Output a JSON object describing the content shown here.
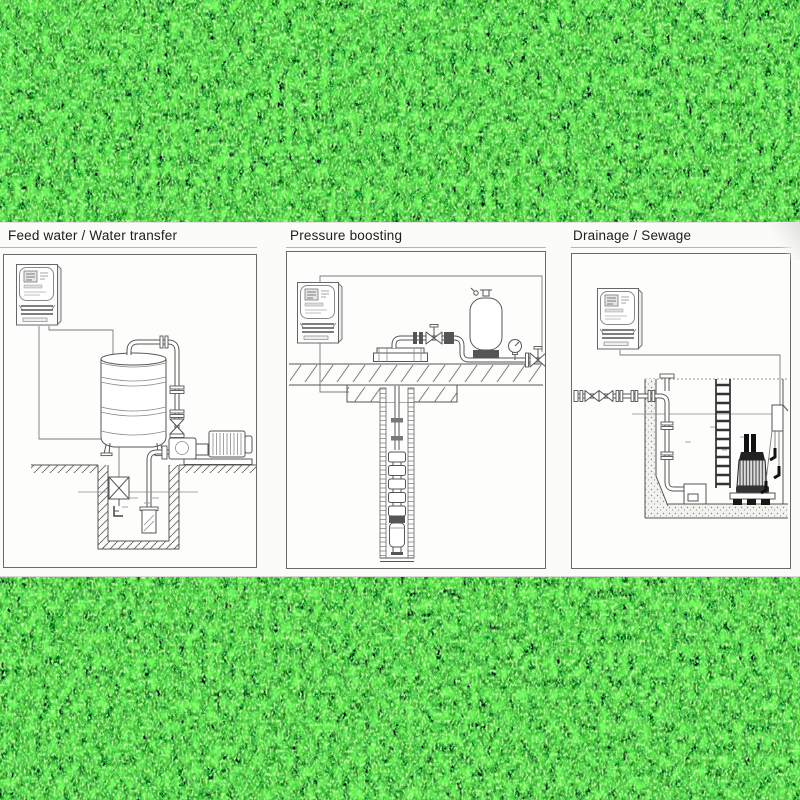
{
  "background": {
    "type": "artificial-turf-photo",
    "base_color": "#15741a",
    "highlight_color": "#9fe87c",
    "shadow_color": "#063c08"
  },
  "strip": {
    "background_color": "#fbfbf8",
    "frame_color": "#6a6a6a",
    "line_color": "#555555",
    "panels": [
      {
        "title": "Feed water / Water transfer",
        "components": [
          "pump-controller",
          "control-cables",
          "storage-tank",
          "level-probe",
          "discharge-pipe",
          "gate-valve",
          "surface-pump",
          "motor",
          "suction-pipe",
          "foot-valve",
          "float-switch",
          "well-water-level",
          "hatched-ground",
          "well-pit"
        ]
      },
      {
        "title": "Pressure boosting",
        "components": [
          "pump-controller",
          "control-cables",
          "wellhead-flange",
          "gate-valve",
          "check-valve",
          "diaphragm-pressure-tank",
          "pressure-gauge",
          "outlet-valve",
          "concrete-slab",
          "borehole-casing",
          "riser-pipe",
          "submersible-multistage-pump",
          "pump-motor"
        ]
      },
      {
        "title": "Drainage / Sewage",
        "components": [
          "pump-controller",
          "control-cables",
          "discharge-manifold",
          "gate-valves",
          "pipe-flanges",
          "tee-blind-flange",
          "drop-pipe",
          "auto-coupling-base",
          "access-ladder",
          "submersible-sewage-pump",
          "float-switches",
          "concrete-sump",
          "sump-water-level"
        ]
      }
    ]
  }
}
